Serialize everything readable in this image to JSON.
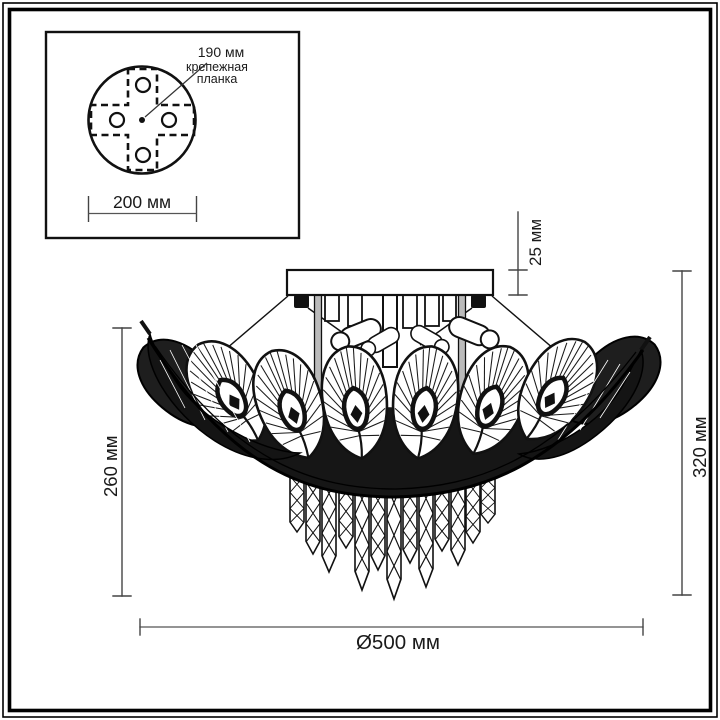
{
  "inset": {
    "dim_190": "190 мм",
    "bracket_line1": "крепежная",
    "bracket_line2": "планка",
    "dim_200": "200 мм"
  },
  "dims": {
    "plate_thickness": "25 мм",
    "shade_height": "260 мм",
    "total_height": "320 мм",
    "diameter": "Ø500 мм"
  },
  "colors": {
    "ink": "#111111",
    "dim_line": "#555555",
    "shade_fill": "#161616"
  }
}
